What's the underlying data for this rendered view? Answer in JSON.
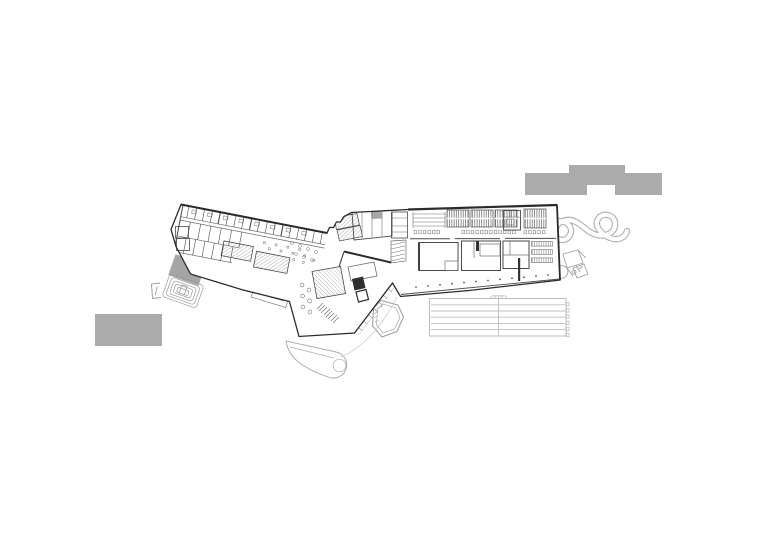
{
  "document": {
    "kind": "architectural ground-floor site plan drawing",
    "visible_text": "none",
    "background_color": "#ffffff"
  },
  "palette": {
    "paper": "#ffffff",
    "context_gray": "#ababab",
    "amph_gray": "#a5a5a5",
    "wall_dark": "#2b2b2b",
    "wall_mid": "#4a4a4a",
    "line_mid": "#6e6e6e",
    "line_light": "#9a9a9a",
    "landscape": "#b2b2b2",
    "track": "#bdbdbd",
    "faint": "#c9c9c9"
  },
  "elements": {
    "context_buildings": [
      {
        "name": "context-building-north",
        "shape": "notched bar",
        "fill": "#ababab"
      },
      {
        "name": "context-building-southwest",
        "shape": "rectangle",
        "fill": "#ababab"
      }
    ],
    "main_building": {
      "wings": [
        "left-angled-wing",
        "junction-block",
        "right-rect-wing",
        "south-wedge"
      ],
      "features": [
        "library-stacks",
        "hatched-rooms",
        "courtyard-garden",
        "colonnade-edge",
        "stair-cores"
      ]
    },
    "landscape": {
      "amphitheater_terraces": {
        "rings": 5,
        "fill": "#a5a5a5"
      },
      "running_track": {
        "lane_lines": 5,
        "lanes": 6,
        "center_divider": 1,
        "right_edge_ticks": 6
      },
      "loop_sculpture": {
        "style": "interlaced ribbon loops"
      },
      "entry_ramp": {
        "style": "rounded paddle path"
      },
      "rock_feature": {
        "style": "faceted polygon with inner offset"
      },
      "pavilion_sketch": {
        "style": "loose rotated volumes"
      }
    }
  }
}
